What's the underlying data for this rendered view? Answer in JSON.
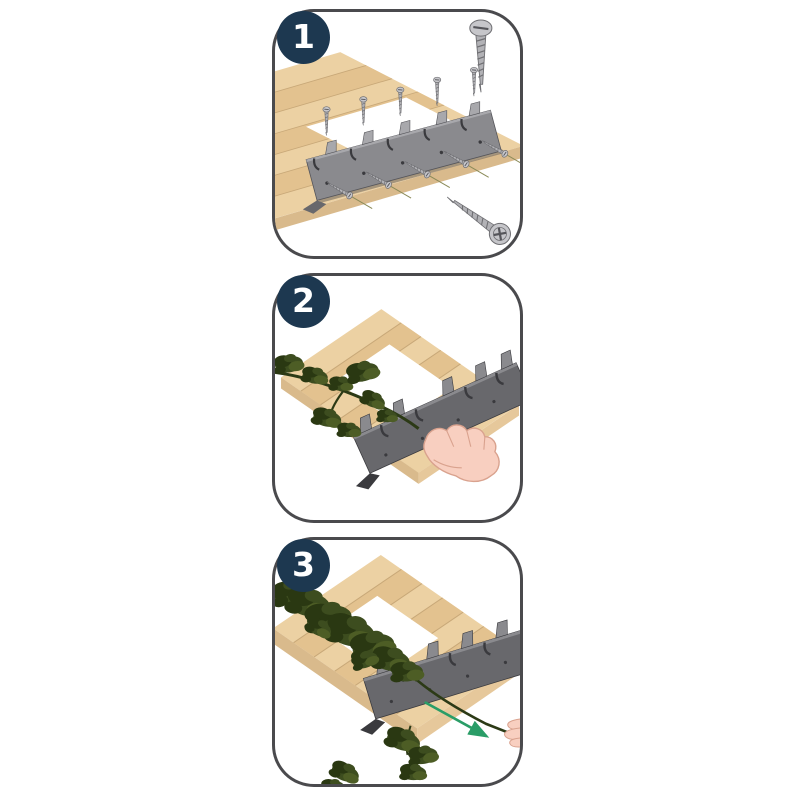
{
  "title_visible_text": "",
  "steps": [
    {
      "number": "1"
    },
    {
      "number": "2"
    },
    {
      "number": "3"
    }
  ],
  "icons": {
    "badge": "step-number-badge",
    "screw_upright": "wood-screw-icon",
    "screw_angled": "phillips-screw-icon",
    "bracket": "serrated-mounting-bracket",
    "deck": "wood-plank-deck-with-opening",
    "vine": "vine-branch",
    "hand": "pressing-hand-icon",
    "fingers": "pulling-fingers-icon",
    "arrow": "pull-direction-arrow-icon"
  },
  "palette": {
    "navy": "#1d3850",
    "border": "#4a4a4d",
    "wood": "#ecd1a3",
    "wood_dark": "#e3c28f",
    "wood_side": "#d9ba8c",
    "wood_side2": "#e6c89b",
    "wood_line": "#c8a878",
    "steel": "#8a8a8e",
    "steel2": "#68686c",
    "steel_light": "#a8a8ac",
    "steel_edge": "#55555a",
    "slot_dark": "#3a3a3e",
    "screw_body": "#b2b2b6",
    "screw_head": "#c6c6ca",
    "screw_line": "#6f6f73",
    "guide_line": "#8a8a58",
    "green_stem": "#2c3a16",
    "green_leaf": "#3d4d1f",
    "green_leaf_dark": "#2a3812",
    "green_leaf_light": "#4d5d25",
    "skin": "#f8cfc0",
    "skin_line": "#d9a28e",
    "arrow": "#2a9d67",
    "shadow": "#6b655c"
  }
}
